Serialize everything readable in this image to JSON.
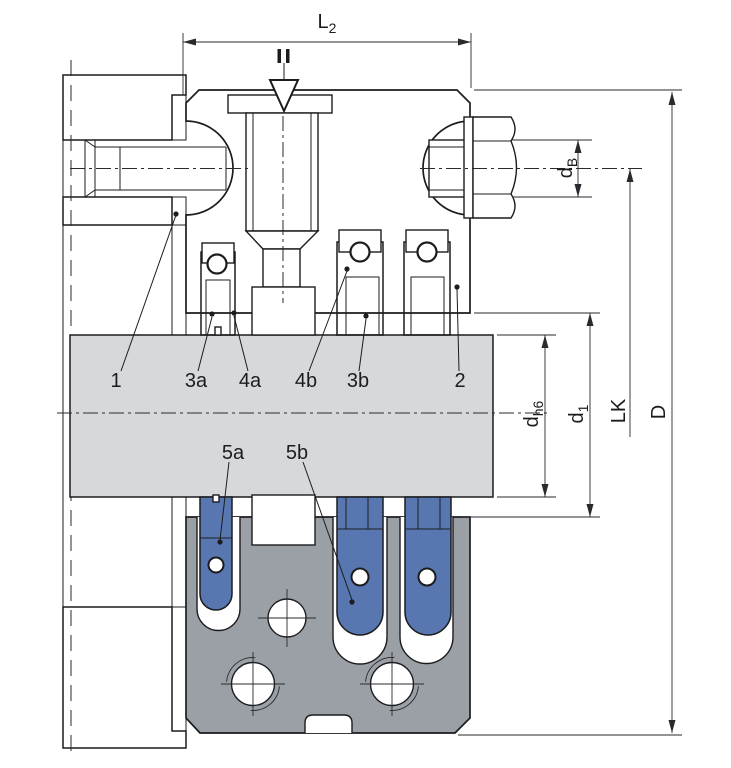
{
  "dimensions": {
    "l2": {
      "base": "L",
      "sub": "2"
    },
    "db": {
      "base": "d",
      "sub": "B"
    },
    "dh6": {
      "base": "d",
      "sub": "h6"
    },
    "d1": {
      "base": "d",
      "sub": "1"
    },
    "lk": {
      "label": "LK"
    },
    "d_outer": {
      "label": "D"
    }
  },
  "callouts": {
    "c1": "1",
    "c2": "2",
    "c3a": "3a",
    "c3b": "3b",
    "c4a": "4a",
    "c4b": "4b",
    "c5a": "5a",
    "c5b": "5b"
  },
  "colors": {
    "line": "#1c1c1f",
    "dim": "#2a2a2e",
    "gland_gray": "#9aa0a6",
    "gland_hatch": "#24262a",
    "shaft_gray": "#d6d8da",
    "packing_blue": "#5b77ae",
    "packing_hatch": "#263459",
    "gasket_blue": "#abc7e0",
    "gasket_hatch": "#31517d",
    "spring_blue": "#5877b0",
    "housing_hatch": "#2b2b2e"
  }
}
